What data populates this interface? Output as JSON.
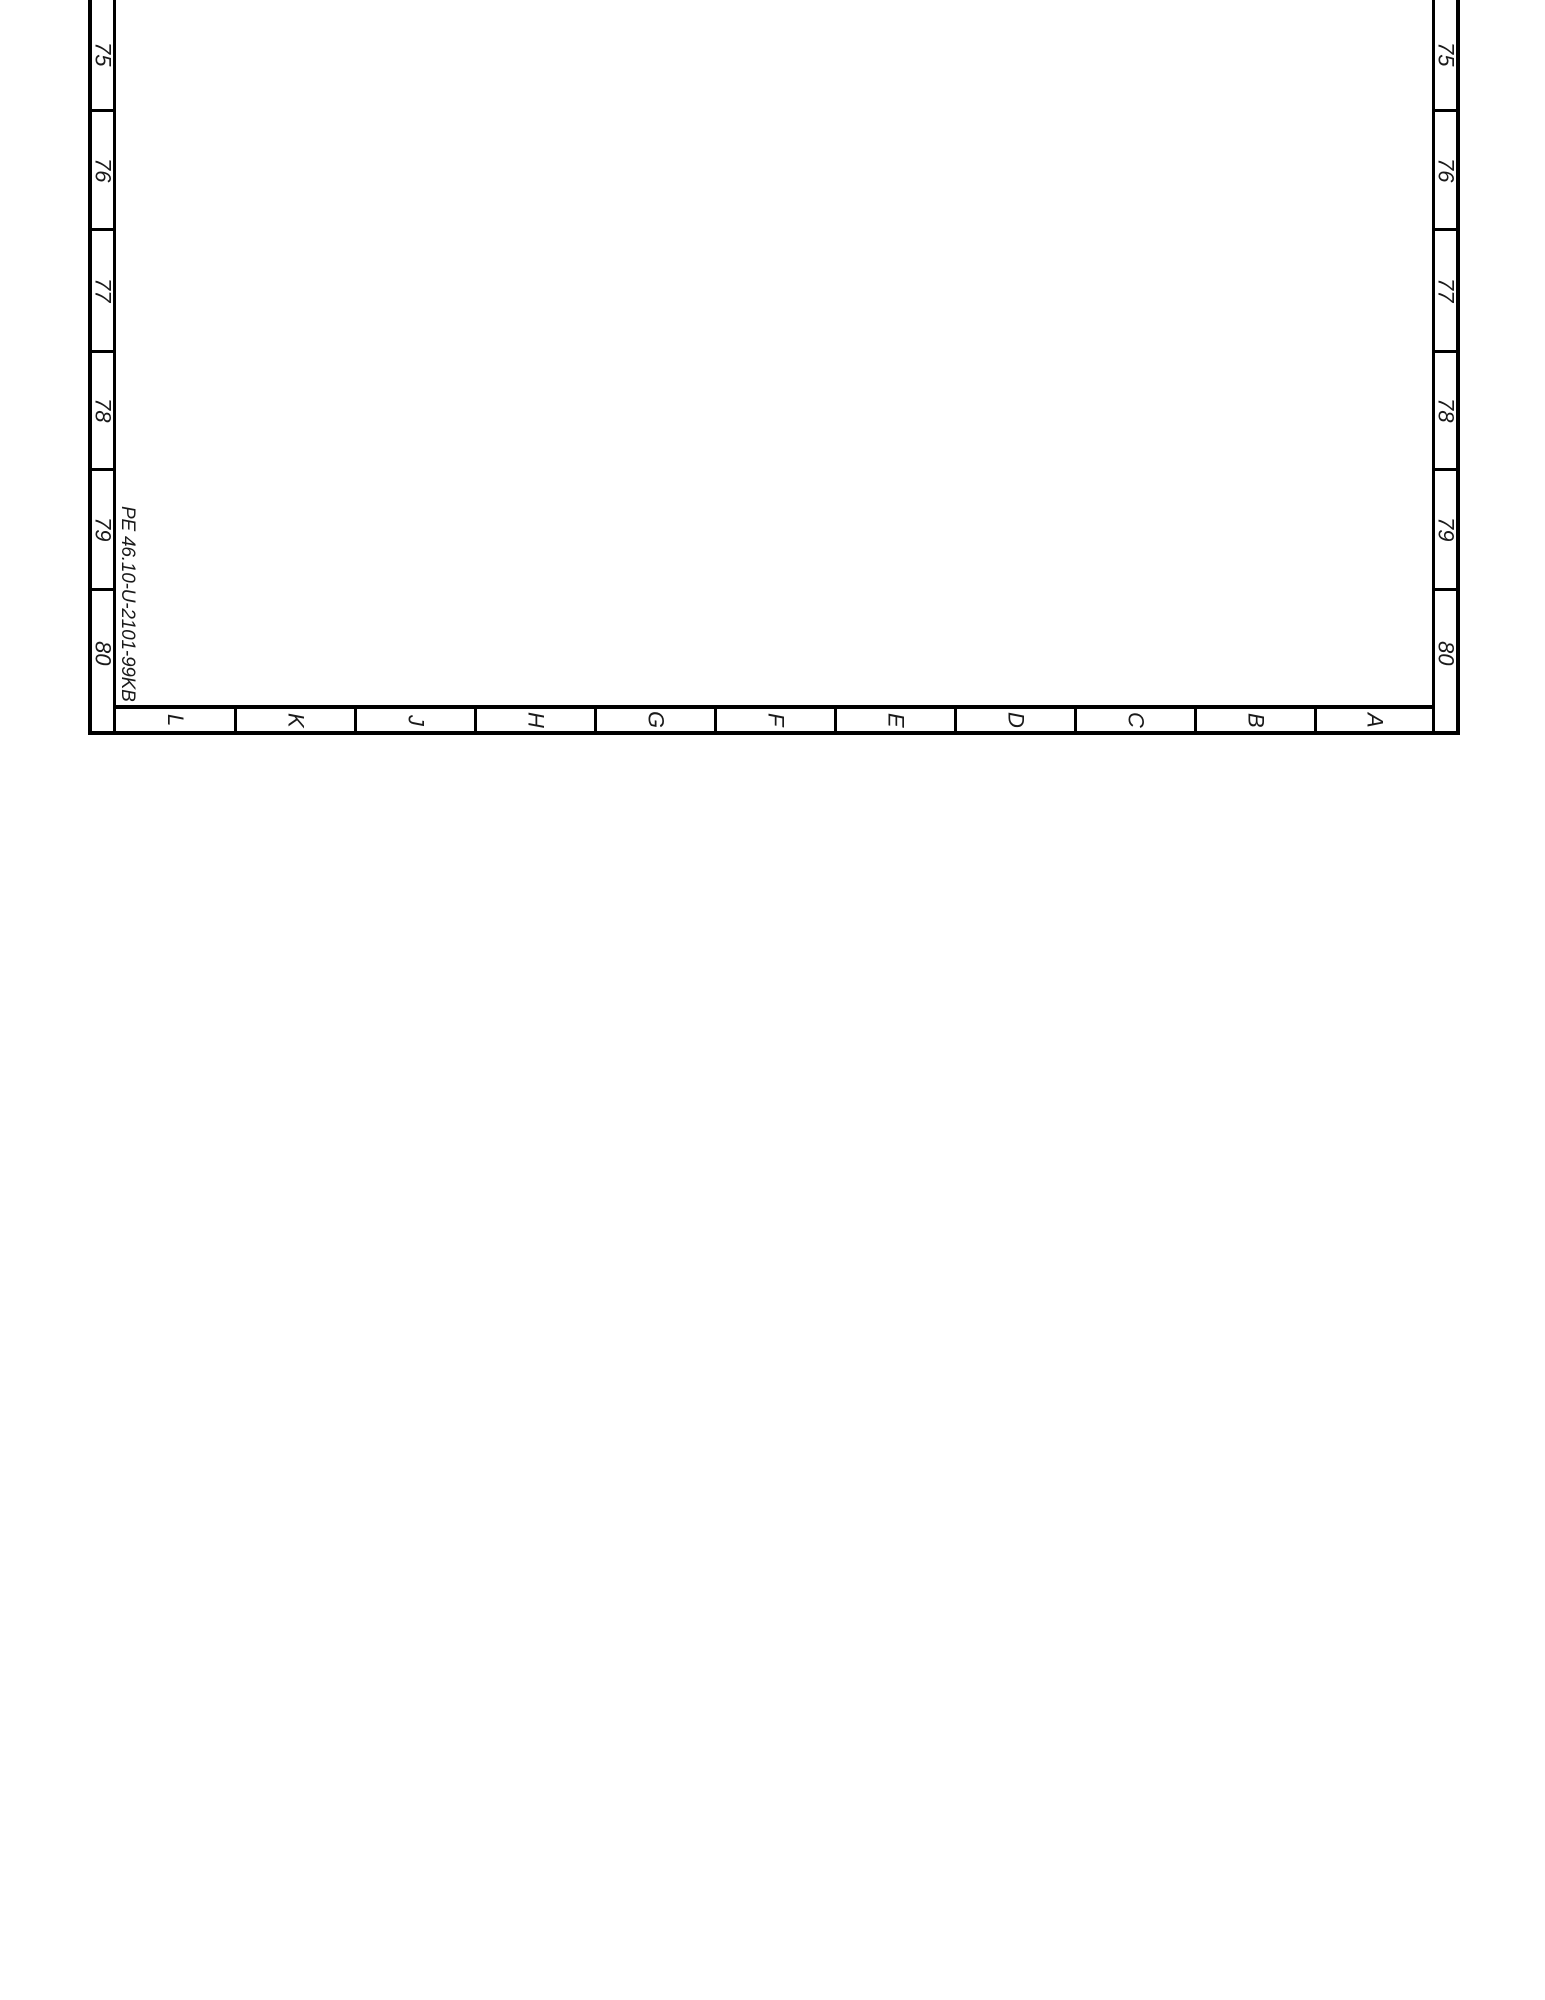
{
  "sheet": {
    "drawing_number": "PE 46.10-U-2101-99KB",
    "row_labels": [
      "75",
      "76",
      "77",
      "78",
      "79",
      "80"
    ],
    "column_labels": [
      "L",
      "K",
      "J",
      "H",
      "G",
      "F",
      "E",
      "D",
      "C",
      "B",
      "A"
    ],
    "colors": {
      "background": "#ffffff",
      "line": "#000000",
      "text": "#1a1a1a"
    }
  }
}
